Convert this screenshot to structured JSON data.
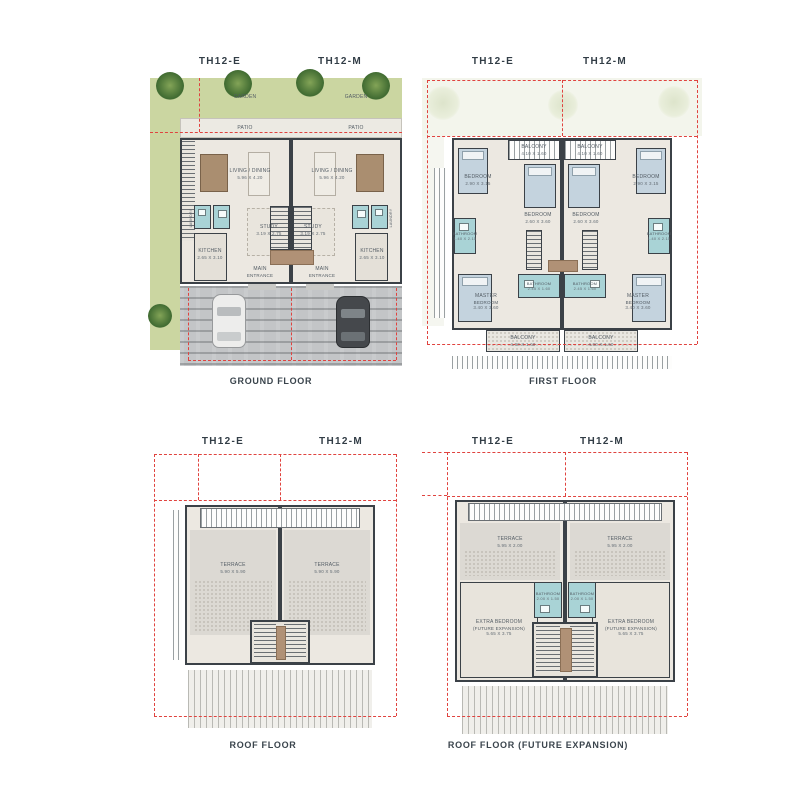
{
  "colors": {
    "plot_boundary_red": "#e0433f",
    "wall_dark": "#3b4147",
    "garden_green": "#cbd6a1",
    "wet_area_teal": "#a9d3d6",
    "floor_beige": "#ece8e1",
    "label_text": "#3a444c"
  },
  "panels": [
    {
      "caption": "GROUND FLOOR",
      "unit_left": "TH12-E",
      "unit_right": "TH12-M",
      "labels": {
        "garden": "GARDEN",
        "patio": "PATIO",
        "living": "LIVING / DINING",
        "living_dim": "5.96 X 4.20",
        "study": "STUDY",
        "study_dim": "3.19 X 2.75",
        "kitchen": "KITCHEN",
        "kitchen_dim": "2.65 X 3.10",
        "laundry": "LAUNDRY",
        "entrance_1": "MAIN",
        "entrance_2": "ENTRANCE"
      }
    },
    {
      "caption": "FIRST FLOOR",
      "unit_left": "TH12-E",
      "unit_right": "TH12-M",
      "labels": {
        "balcony": "BALCONY",
        "balcony_top_dim": "4.10 X 1.60",
        "balcony_bottom_dim": "4.00 X 1.60",
        "bedroom": "BEDROOM",
        "bedroom_outer_dim": "2.90 X 3.15",
        "bedroom_inner_dim": "2.60 X 3.60",
        "bathroom": "BATHROOM",
        "bathroom_side_dim": "1.40 X 2.15",
        "bathroom_mid_dim": "2.45 X 1.60",
        "master_1": "MASTER",
        "master_2": "BEDROOM",
        "master_dim": "3.40 X 3.60"
      }
    },
    {
      "caption": "ROOF FLOOR",
      "unit_left": "TH12-E",
      "unit_right": "TH12-M",
      "labels": {
        "terrace": "TERRACE",
        "terrace_dim": "5.90 X 5.90"
      }
    },
    {
      "caption": "ROOF FLOOR (FUTURE EXPANSION)",
      "unit_left": "TH12-E",
      "unit_right": "TH12-M",
      "labels": {
        "terrace": "TERRACE",
        "terrace_dim": "5.95 X 2.00",
        "bathroom": "BATHROOM",
        "bathroom_dim": "2.00 X 1.50",
        "extra_1": "EXTRA BEDROOM",
        "extra_2": "(FUTURE EXPANSION)",
        "extra_dim": "5.65 X 3.75"
      }
    }
  ]
}
